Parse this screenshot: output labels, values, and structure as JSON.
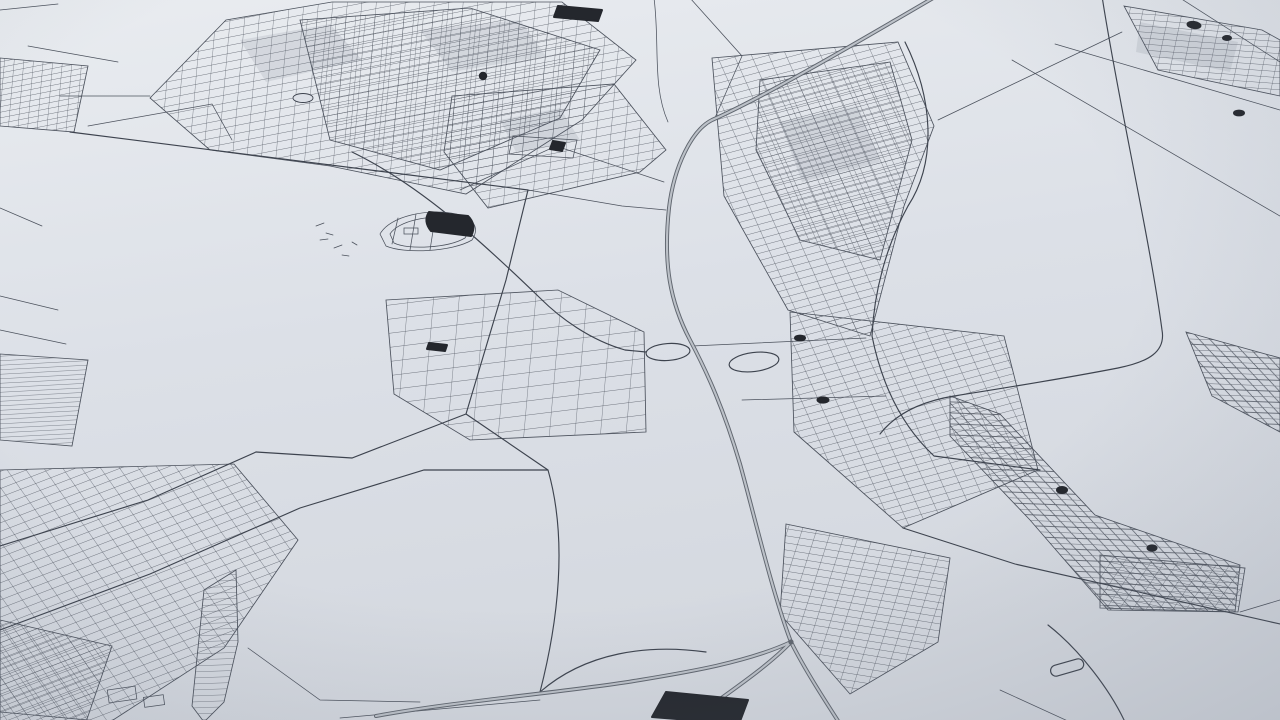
{
  "scene": {
    "description": "Oblique aerial 3D render of a monochrome city street map with a central highway corridor, interchange loops, dense urban grids and scattered dark water/building fills",
    "visible_text": "none"
  },
  "colors": {
    "bg_top": "#e9ecf0",
    "bg_mid": "#dce0e7",
    "bg_bottom": "#d4d8df",
    "vignette": "rgba(104,114,130,0.22)",
    "road_thin": "#4b515c",
    "road_medium": "#3d434e",
    "highway_casing": "#60666f",
    "highway_inner": "#bcc1c8",
    "solid_fill": "#24272d",
    "block_shade": "rgba(92,102,118,0.13)"
  },
  "features": [
    "urban-grid-northwest",
    "urban-grid-top-center",
    "urban-grid-northeast-corner",
    "urban-grid-east-upper",
    "urban-grid-east-lower",
    "urban-grid-southeast-band",
    "urban-grid-southeast-patch",
    "urban-grid-bottom-center",
    "urban-grid-southwest",
    "sail-shaped-blocks",
    "field-rows-west",
    "small-grid-top-left",
    "suburban-grid-center",
    "highway-corridor",
    "highway-south-junction",
    "interchange-loops",
    "ring-road-east",
    "stadium-park-outline",
    "dark-water-building-fills",
    "pond-roundabout",
    "field-plot-with-marker"
  ]
}
